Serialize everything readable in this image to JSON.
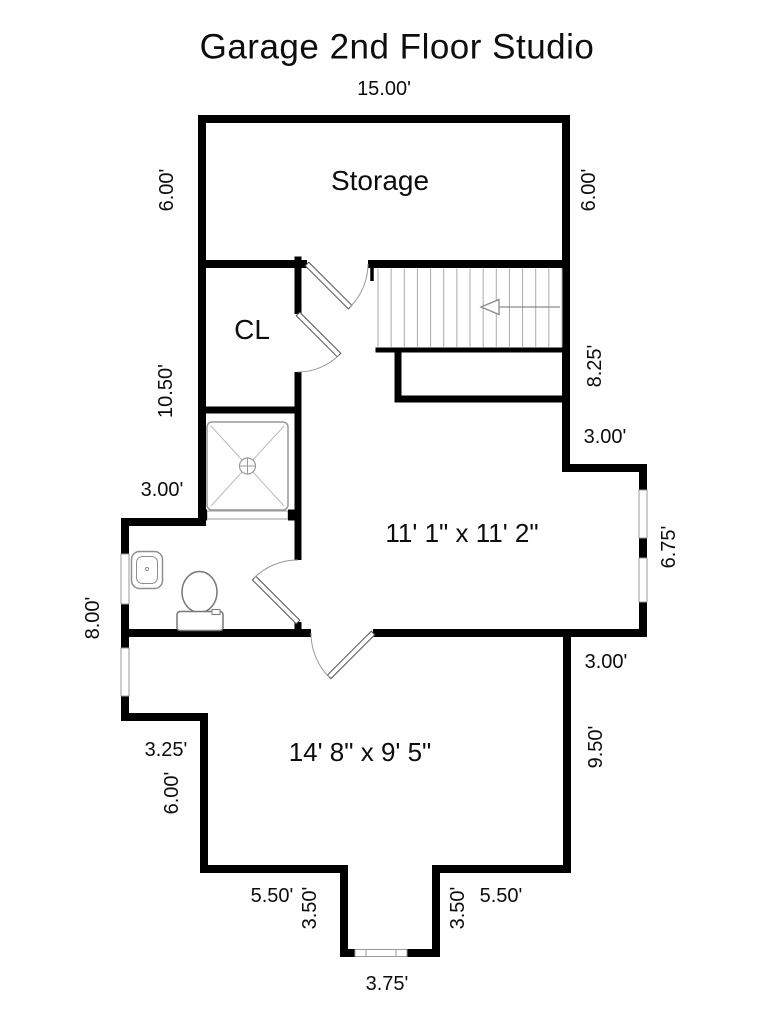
{
  "title": "Garage 2nd Floor Studio",
  "rooms": {
    "storage": {
      "label": "Storage"
    },
    "closet": {
      "label": "CL"
    },
    "studio": {
      "size_label": "11' 1\" x 11' 2\""
    },
    "bonus_room": {
      "size_label": "14' 8\" x 9' 5\""
    }
  },
  "dims": {
    "top_width": "15.00'",
    "storage_left_height": "6.00'",
    "storage_right_height": "6.00'",
    "left_mid_height": "10.50'",
    "stairwell_right_height": "8.25'",
    "bath_step_width": "3.00'",
    "bump_top_width": "3.00'",
    "bump_right_height": "6.75'",
    "left_lower_height": "8.00'",
    "bump_bottom_width": "3.00'",
    "bottom_step_width": "3.25'",
    "bottom_left_height": "6.00'",
    "bottom_right_height": "9.50'",
    "bottom_left_width": "5.50'",
    "alcove_left_depth": "3.50'",
    "alcove_right_depth": "3.50'",
    "bottom_right_width": "5.50'",
    "alcove_width": "3.75'"
  },
  "fixtures": [
    "staircase",
    "stair-direction-arrow",
    "shower",
    "sink",
    "toilet"
  ],
  "colors": {
    "walls": "#000000",
    "background": "#ffffff",
    "fixture_stroke": "#8f8f8f",
    "text": "#0d0d0d"
  }
}
